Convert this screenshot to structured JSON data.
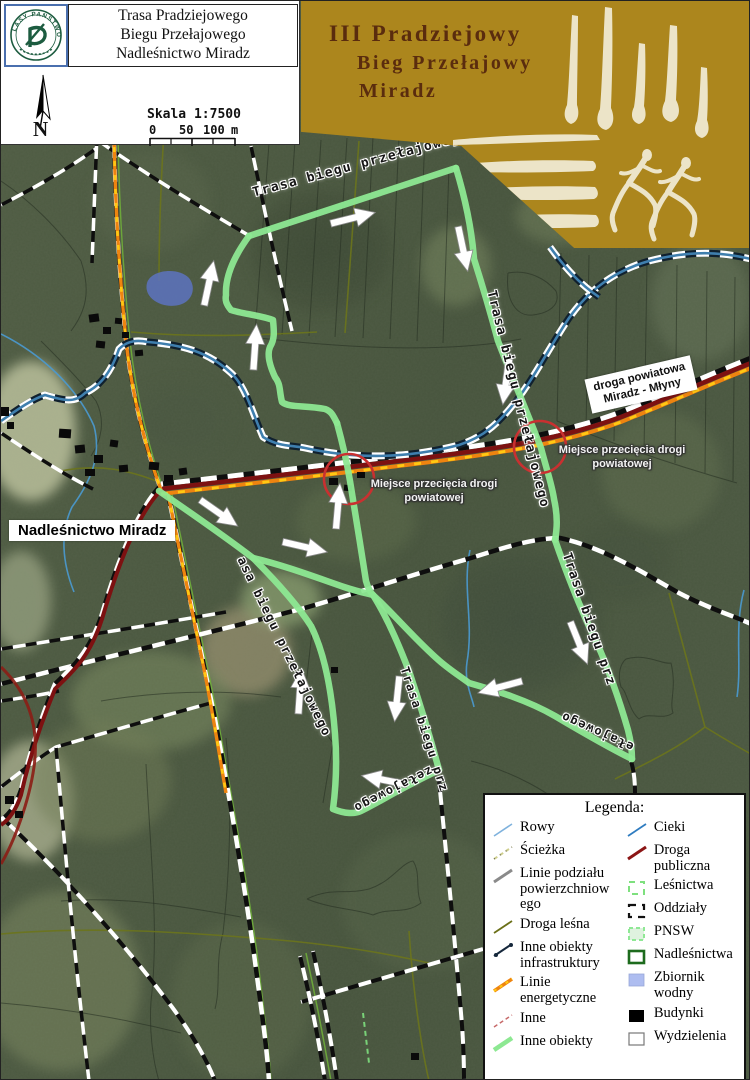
{
  "header": {
    "logo_text": "LASY PAŃSTWOWE",
    "title_lines": [
      "Trasa Pradziejowego",
      "Biegu Przełajowego",
      "Nadleśnictwo Miradz"
    ],
    "north_label": "N",
    "scale_label": "Skala 1:7500",
    "scale_ticks": {
      "zero": "0",
      "fifty": "50",
      "hundred": "100",
      "unit": "m"
    }
  },
  "banner": {
    "title_lines": [
      "III Pradziejowy",
      "Bieg Przełajowy",
      "Miradz"
    ],
    "bg_color": "#ac861d",
    "text_color": "#5a2c0e",
    "art_color": "#ece4c8"
  },
  "map": {
    "office_label": "Nadleśnictwo Miradz",
    "road_label_lines": [
      "droga powiatowa",
      "Miradz - Młyny"
    ],
    "crossings": [
      {
        "line1": "Miejsce przecięcia drogi",
        "line2": "powiatowej"
      },
      {
        "line1": "Miejsce przecięcia drogi",
        "line2": "powiatowej"
      }
    ],
    "trail_labels": [
      {
        "text": "Trasa biegu przełajowego"
      },
      {
        "text": "Trasa biegu przełajowego"
      },
      {
        "text": "asa biegu przełajowego"
      },
      {
        "text": "Trasa biegu prz"
      },
      {
        "text": "ełajowego"
      },
      {
        "text": "Trasa biegu prz"
      },
      {
        "text": "zełajowego"
      }
    ],
    "arrows": [
      [
        352,
        217,
        -14
      ],
      [
        208,
        282,
        -78
      ],
      [
        254,
        346,
        -86
      ],
      [
        462,
        248,
        78
      ],
      [
        505,
        381,
        98
      ],
      [
        337,
        505,
        -85
      ],
      [
        218,
        512,
        35
      ],
      [
        304,
        546,
        13
      ],
      [
        299,
        690,
        -86
      ],
      [
        396,
        698,
        96
      ],
      [
        383,
        779,
        191
      ],
      [
        578,
        642,
        68
      ],
      [
        499,
        686,
        165
      ]
    ],
    "colors": {
      "trail": "#8de892",
      "road_public": "#7d1111",
      "powerline_orange": "#ee8410",
      "powerline_yellow": "#ffc913",
      "infrastructure_blue": "#3f7fae",
      "water": "#5d74c4",
      "crossing_circle": "#c93030"
    }
  },
  "legend": {
    "title": "Legenda:",
    "left": [
      {
        "label": "Rowy"
      },
      {
        "label": "Ścieżka"
      },
      {
        "label": "Linie podziału powierzchniow ego"
      },
      {
        "label": "Droga leśna"
      },
      {
        "label": "Inne obiekty infrastruktury"
      },
      {
        "label": "Linie energetyczne"
      },
      {
        "label": "Inne"
      },
      {
        "label": "Inne obiekty"
      }
    ],
    "right": [
      {
        "label": "Cieki"
      },
      {
        "label": "Droga publiczna"
      },
      {
        "label": "Leśnictwa"
      },
      {
        "label": "Oddziały"
      },
      {
        "label": "PNSW"
      },
      {
        "label": "Nadleśnictwa"
      },
      {
        "label": "Zbiornik wodny"
      },
      {
        "label": "Budynki"
      },
      {
        "label": "Wydzielenia"
      }
    ]
  }
}
